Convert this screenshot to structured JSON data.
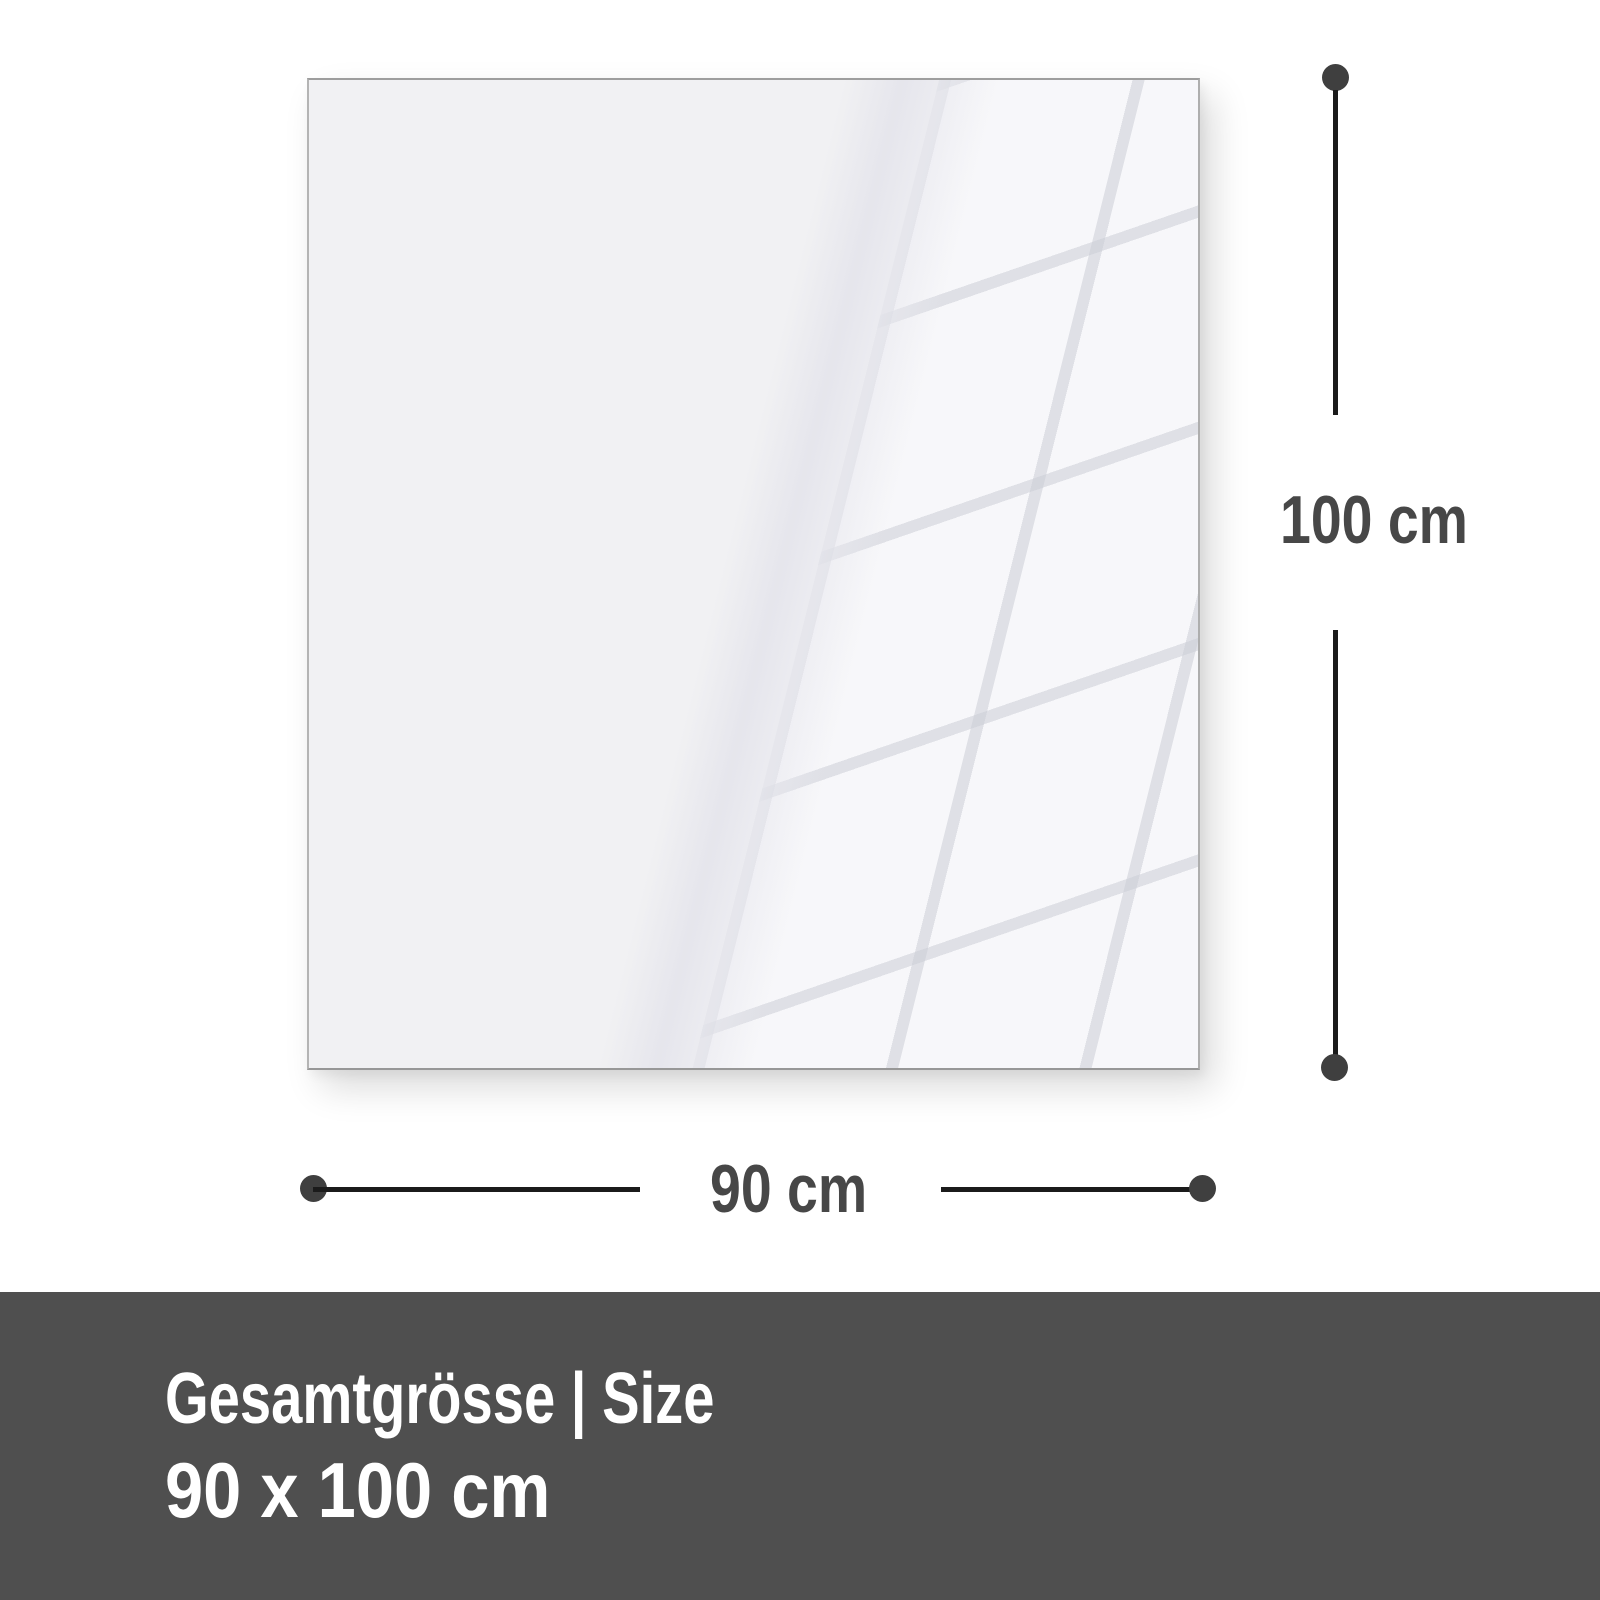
{
  "diagram": {
    "height_dimension": {
      "label": "100 cm"
    },
    "width_dimension": {
      "label": "90 cm"
    }
  },
  "footer": {
    "title": "Gesamtgrösse | Size",
    "size": "90 x 100 cm"
  },
  "colors": {
    "background": "#ffffff",
    "panel_fill": "#f1f1f3",
    "panel_border": "#a5a5a5",
    "line": "#1b1b1b",
    "dot": "#3f3f3f",
    "dimension_text": "#474747",
    "footer_bg": "#4f4f4f",
    "footer_text": "#ffffff"
  }
}
